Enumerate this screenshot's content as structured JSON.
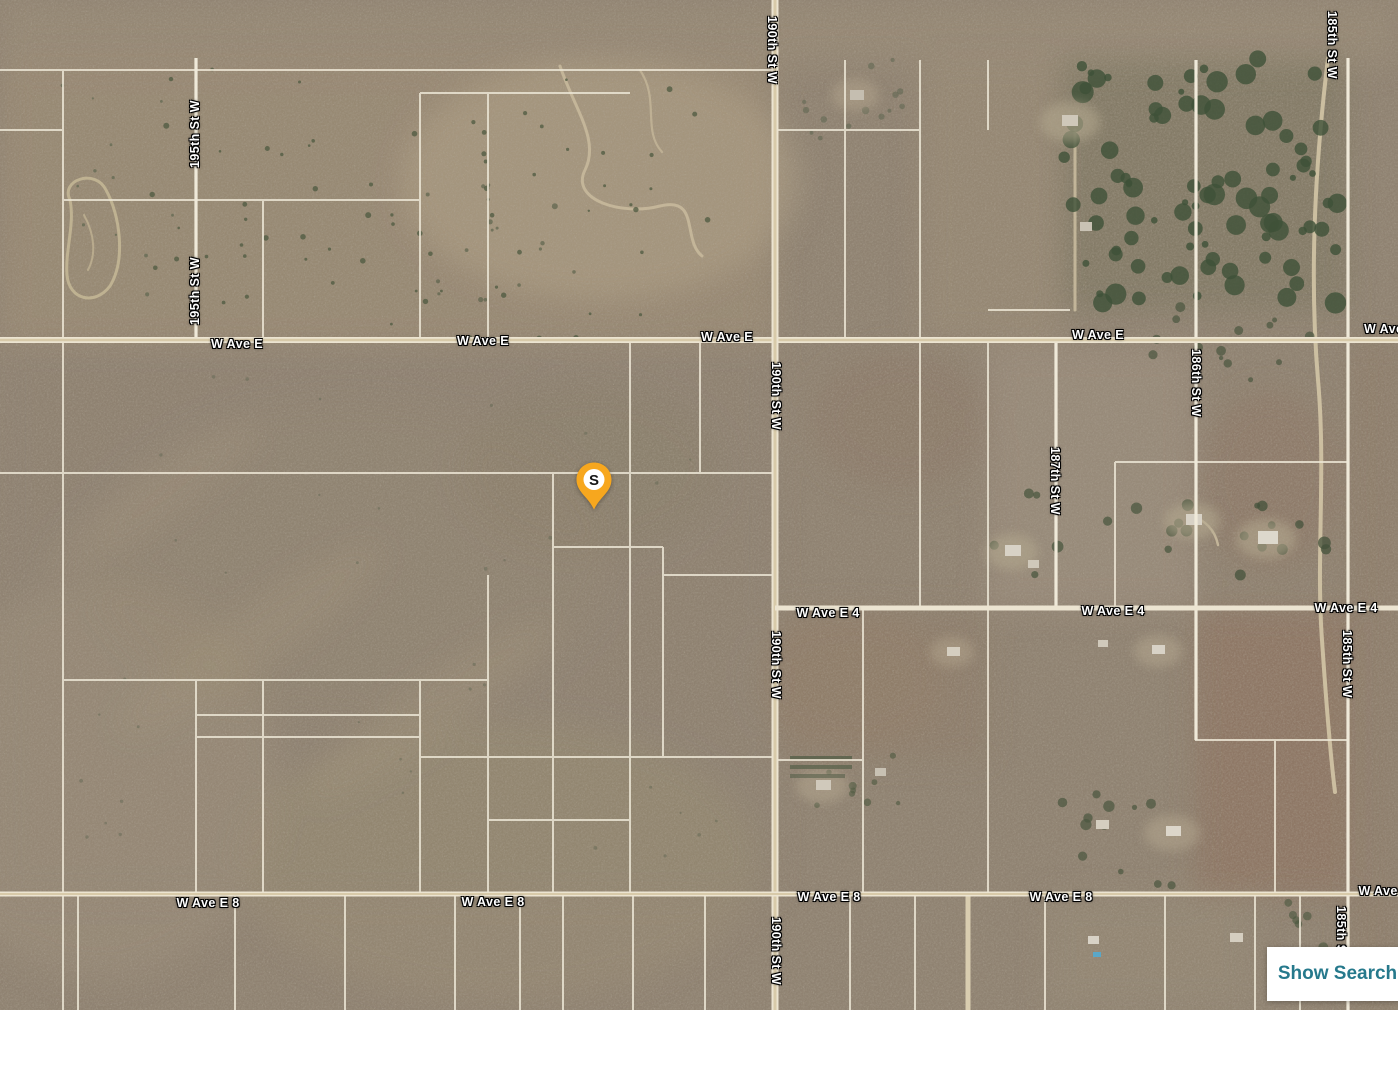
{
  "map": {
    "type_label": "satellite",
    "marker": {
      "label": "S",
      "pin_color": "#F7A71E",
      "inner_circle_color": "#FFFFFF",
      "letter_color": "#161616"
    },
    "button": {
      "label": "Show Search",
      "text_color": "#26798C",
      "background_color": "#FFFFFF"
    },
    "street_labels": [
      {
        "text": "195th St W",
        "x": 195,
        "y": 134,
        "rot": -90
      },
      {
        "text": "195th St W",
        "x": 195,
        "y": 291,
        "rot": -90
      },
      {
        "text": "W Ave E",
        "x": 237,
        "y": 344,
        "rot": 0
      },
      {
        "text": "W Ave E",
        "x": 483,
        "y": 341,
        "rot": 0
      },
      {
        "text": "W Ave E",
        "x": 727,
        "y": 337,
        "rot": 0
      },
      {
        "text": "W Ave E",
        "x": 1098,
        "y": 335,
        "rot": 0
      },
      {
        "text": "W Ave E",
        "x": 1390,
        "y": 329,
        "rot": 0
      },
      {
        "text": "190th St W",
        "x": 772,
        "y": 50,
        "rot": 90
      },
      {
        "text": "190th St W",
        "x": 776,
        "y": 396,
        "rot": 90
      },
      {
        "text": "190th St W",
        "x": 776,
        "y": 665,
        "rot": 90
      },
      {
        "text": "190th St W",
        "x": 776,
        "y": 951,
        "rot": 90
      },
      {
        "text": "187th St W",
        "x": 1055,
        "y": 481,
        "rot": 90
      },
      {
        "text": "186th St W",
        "x": 1196,
        "y": 383,
        "rot": 90
      },
      {
        "text": "185th St W",
        "x": 1332,
        "y": 45,
        "rot": 90
      },
      {
        "text": "185th St W",
        "x": 1347,
        "y": 664,
        "rot": 90
      },
      {
        "text": "185th St W",
        "x": 1341,
        "y": 940,
        "rot": 90
      },
      {
        "text": "W Ave E 4",
        "x": 828,
        "y": 613,
        "rot": 0
      },
      {
        "text": "W Ave E 4",
        "x": 1113,
        "y": 611,
        "rot": 0
      },
      {
        "text": "W Ave E 4",
        "x": 1346,
        "y": 608,
        "rot": 0
      },
      {
        "text": "W Ave E 8",
        "x": 208,
        "y": 903,
        "rot": 0
      },
      {
        "text": "W Ave E 8",
        "x": 493,
        "y": 902,
        "rot": 0
      },
      {
        "text": "W Ave E 8",
        "x": 829,
        "y": 897,
        "rot": 0
      },
      {
        "text": "W Ave E 8",
        "x": 1061,
        "y": 897,
        "rot": 0
      },
      {
        "text": "W Ave E 8",
        "x": 1390,
        "y": 891,
        "rot": 0
      }
    ]
  }
}
